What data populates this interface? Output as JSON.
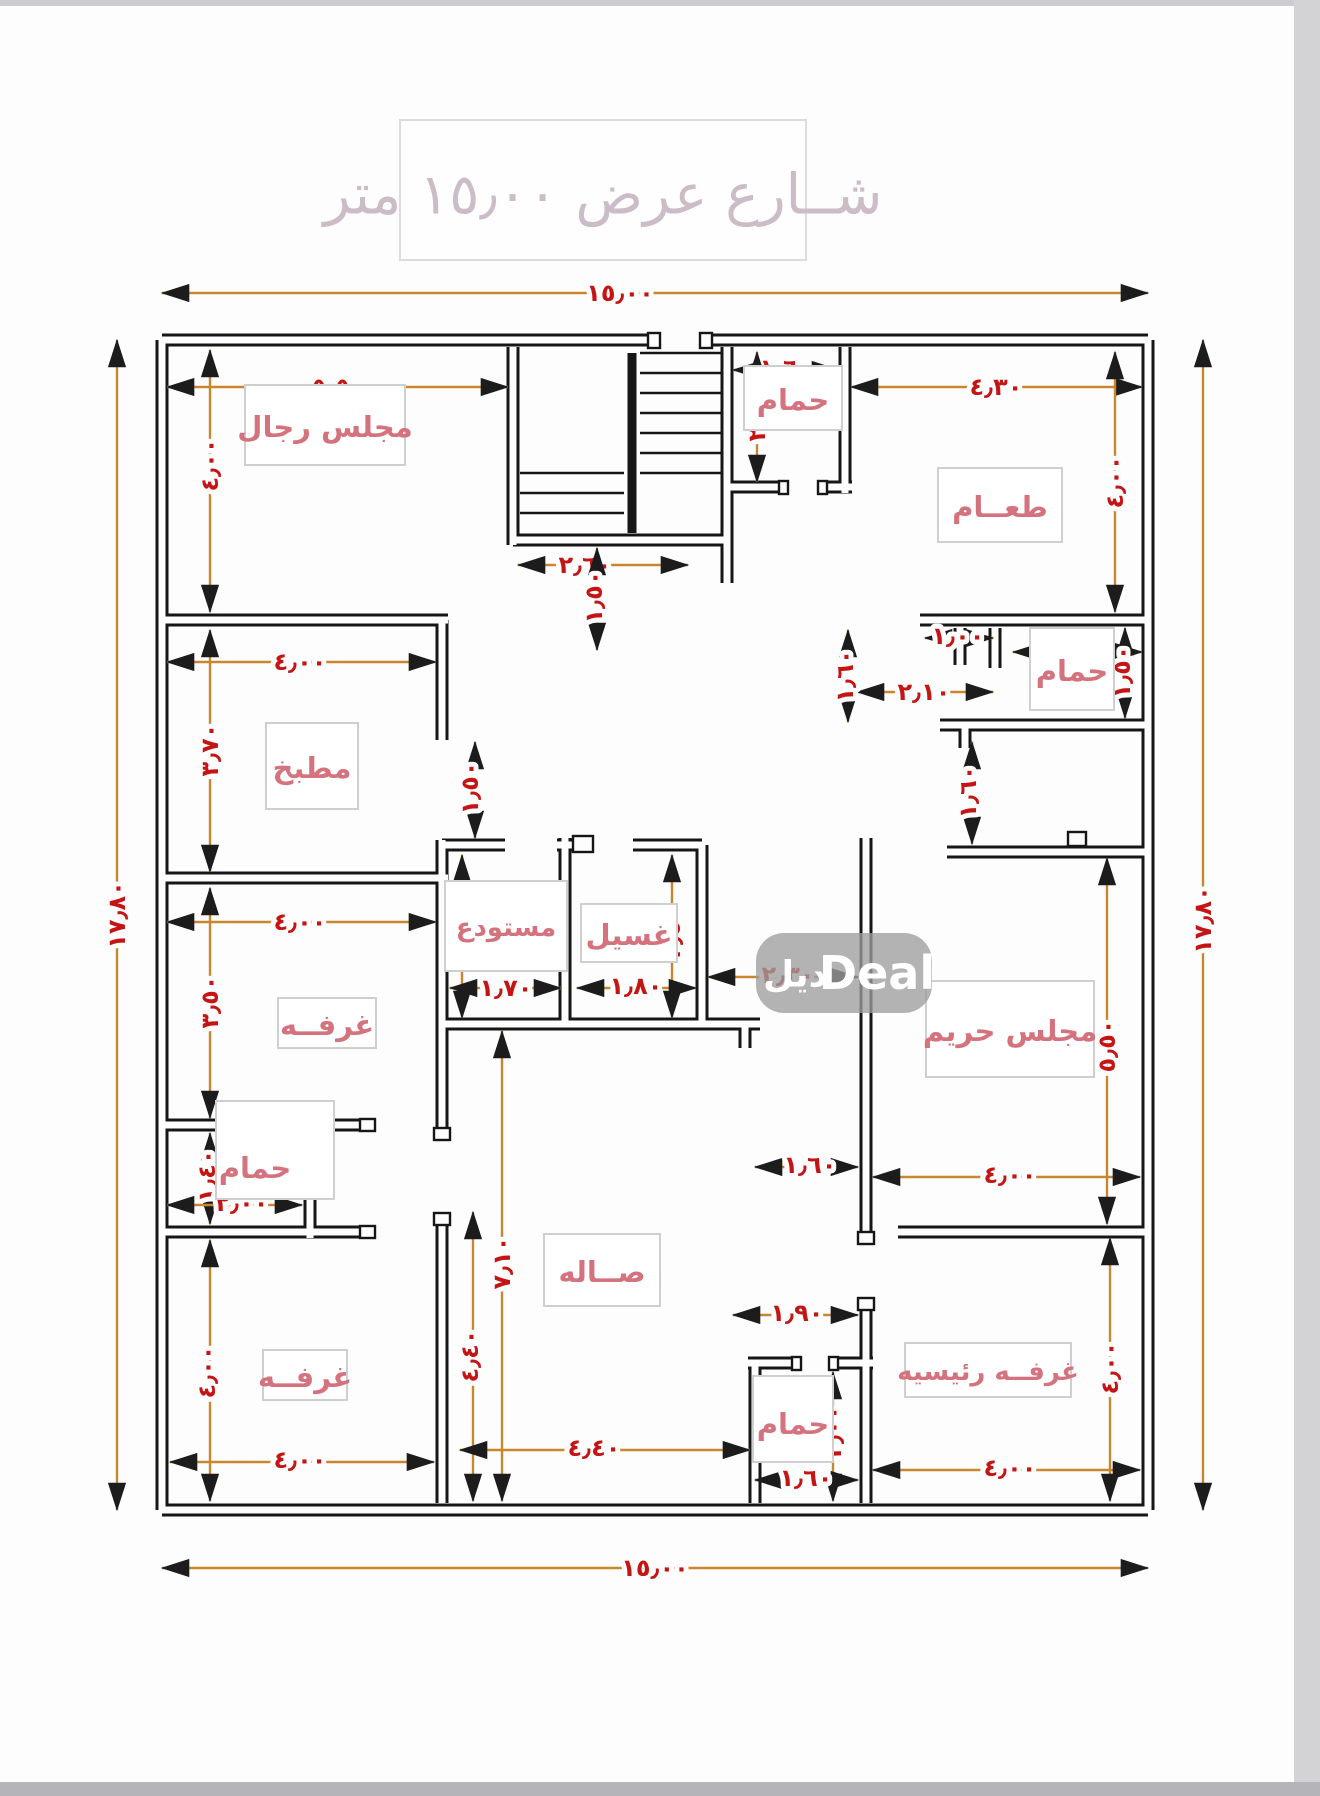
{
  "page": {
    "title": "شــارع عرض ١٥٫٠٠ متر"
  },
  "watermark": {
    "latin": "Deal",
    "arabic": "ديل"
  },
  "rooms": {
    "majlis_rijal": "مجلس رجال",
    "dining": "طعــام",
    "bath_top": "حمام",
    "kitchen": "مطبخ",
    "bath_right": "حمام",
    "storage": "مستودع",
    "laundry": "غسيل",
    "room_mid": "غرفــه",
    "bath_left": "حمام",
    "majlis_hareem": "مجلس حريم",
    "hall": "صــاله",
    "room_bottom": "غرفــه",
    "bath_bottom": "حمام",
    "master": "غرفــه رئيسيه"
  },
  "dims": {
    "top_width": "١٥٫٠٠",
    "bottom_width": "١٥٫٠٠",
    "left_height": "١٧٫٨٠",
    "right_height": "١٧٫٨٠",
    "majlis_w": "٥٫٥٠",
    "majlis_h": "٤٫٠٠",
    "stairs_corridor": "٢٫٦٠",
    "bath_top_w": "١٫٦٠",
    "bath_top_h": "٢٫٠٠",
    "dining_w": "٤٫٣٠",
    "dining_h": "٤٫٠٠",
    "kitchen_w": "٤٫٠٠",
    "kitchen_h": "٣٫٧٠",
    "hall_door": "١٫٥٠",
    "bath_right_door": "١٫٠٠",
    "bath_right_w": "٢٫٠٠",
    "bath_right_pass": "٢٫١٠",
    "bath_right_h": "١٫٥٠",
    "mid_door": "١٫٦٠",
    "storage_door": "١٫٥٠",
    "storage_h": "٢٫٥٠",
    "storage_w": "١٫٧٠",
    "laundry_h": "٢٫٥٠",
    "laundry_w": "١٫٨٠",
    "hall_pass": "٢٫٣٠",
    "hareem_door": "١٫٦٠",
    "room_mid_w": "٤٫٠٠",
    "room_mid_h": "٣٫٥٠",
    "bath_left_h": "١٫٤٠",
    "bath_left_w": "٢٫٠٠",
    "hareem_h": "٥٫٥٠",
    "hareem_w": "٤٫٠٠",
    "hall_h": "٧٫١٠",
    "hall_h2": "٤٫٤٠",
    "hall_w": "٤٫٤٠",
    "room_bl_h": "٤٫٠٠",
    "room_bl_w": "٤٫٠٠",
    "pass_160": "١٫٦٠",
    "pass_190": "١٫٩٠",
    "bath_bot_h": "٢٫٠٠",
    "bath_bot_w": "١٫٦٠",
    "master_w": "٤٫٠٠",
    "master_h": "٤٫٠٠"
  }
}
